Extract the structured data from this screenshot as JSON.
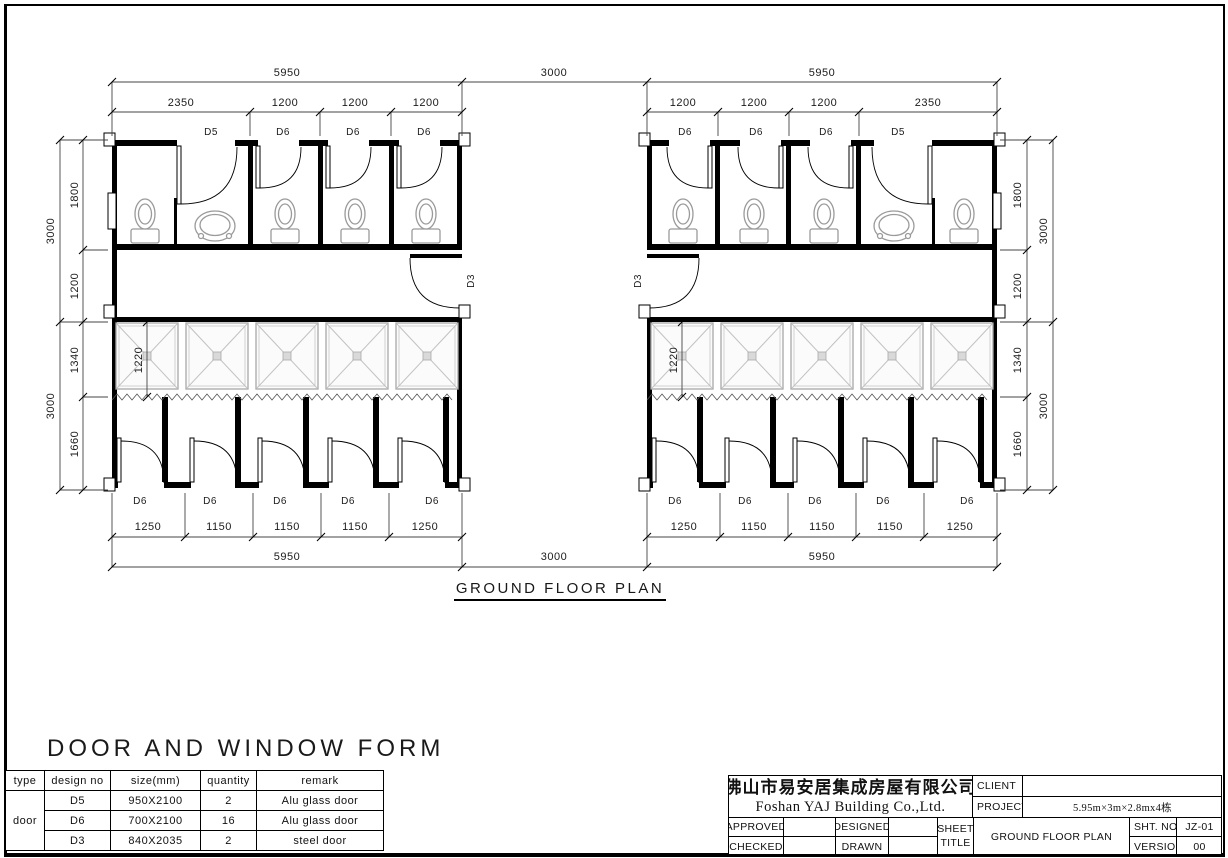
{
  "page": {
    "plan_title": "GROUND FLOOR PLAN",
    "form_title": "DOOR AND WINDOW FORM"
  },
  "dims": {
    "top_overall": [
      "5950",
      "3000",
      "5950"
    ],
    "top_sub_left": [
      "2350",
      "1200",
      "1200",
      "1200"
    ],
    "top_sub_right": [
      "1200",
      "1200",
      "1200",
      "2350"
    ],
    "bottom_overall": [
      "5950",
      "3000",
      "5950"
    ],
    "bottom_sub_left": [
      "1250",
      "1150",
      "1150",
      "1150",
      "1250"
    ],
    "bottom_sub_right": [
      "1250",
      "1150",
      "1150",
      "1150",
      "1250"
    ],
    "side_left_sub": [
      "1800",
      "1200",
      "1340",
      "1660"
    ],
    "side_left_overall": [
      "3000",
      "3000"
    ],
    "side_right_sub": [
      "1800",
      "1200",
      "1340",
      "1660"
    ],
    "side_right_overall": [
      "3000",
      "3000"
    ],
    "shower_left": "1220",
    "shower_right": "1220"
  },
  "doors": {
    "top_left": [
      "D5",
      "D6",
      "D6",
      "D6"
    ],
    "top_right": [
      "D6",
      "D6",
      "D6",
      "D5"
    ],
    "bottom_left": [
      "D6",
      "D6",
      "D6",
      "D6",
      "D6"
    ],
    "bottom_right": [
      "D6",
      "D6",
      "D6",
      "D6",
      "D6"
    ],
    "corridor_left": "D3",
    "corridor_right": "D3"
  },
  "door_table": {
    "headers": [
      "type",
      "design no",
      "size(mm)",
      "quantity",
      "remark"
    ],
    "type_label": "door",
    "rows": [
      {
        "design_no": "D5",
        "size": "950X2100",
        "quantity": "2",
        "remark": "Alu glass door"
      },
      {
        "design_no": "D6",
        "size": "700X2100",
        "quantity": "16",
        "remark": "Alu glass door"
      },
      {
        "design_no": "D3",
        "size": "840X2035",
        "quantity": "2",
        "remark": "steel door"
      }
    ]
  },
  "title_block": {
    "company_cn": "佛山市易安居集成房屋有限公司",
    "company_en": "Foshan YAJ Building Co.,Ltd.",
    "client_label": "CLIENT",
    "client_value": "",
    "project_label": "PROJECT",
    "project_value": "5.95m×3m×2.8mx4栋",
    "approved_label": "APPROVED",
    "checked_label": "CHECKED",
    "designed_label": "DESIGNED",
    "drawn_label": "DRAWN",
    "sheet_label": "SHEET",
    "title_label": "TITLE",
    "sheet_title_value": "GROUND FLOOR PLAN",
    "sht_no_label": "SHT. NO.",
    "sht_no_value": "JZ-01",
    "versions_label": "VERSIONS",
    "versions_value": "00"
  }
}
